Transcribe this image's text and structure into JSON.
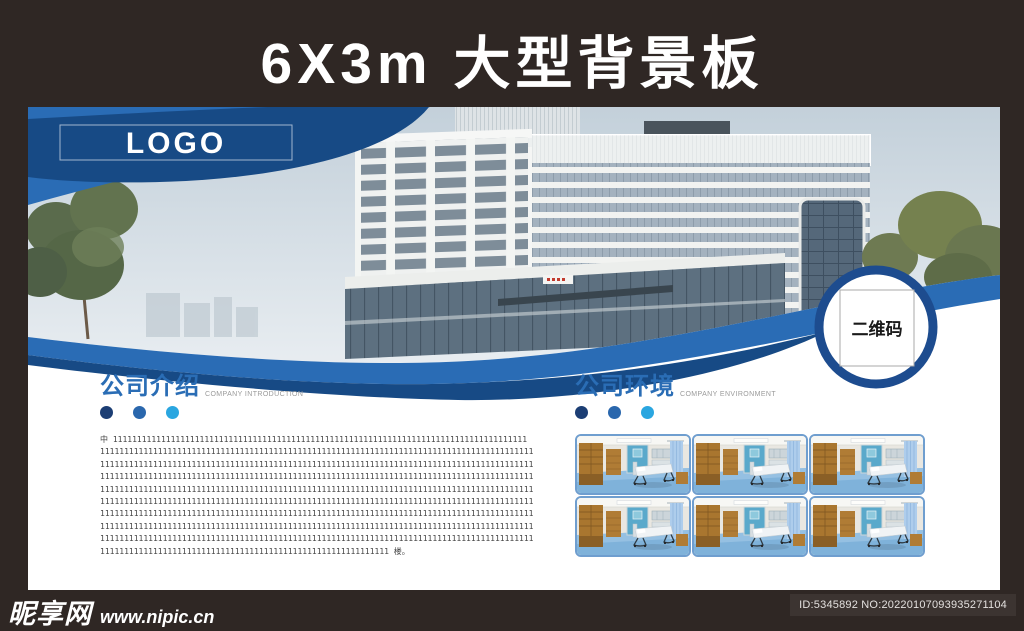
{
  "header": {
    "title": "6X3m 大型背景板"
  },
  "banner": {
    "logo": "LOGO",
    "qr_label": "二维码"
  },
  "sections": {
    "intro": {
      "title": "公司介绍",
      "subtitle": "COMPANY INTRODUCTION",
      "body": [
        "    中 11111111111111111111111111111111111111111111111111111111111111111111111111111111111111",
        "111111111111111111111111111111111111111111111111111111111111111111111111111111111111111111",
        "111111111111111111111111111111111111111111111111111111111111111111111111111111111111111111",
        "111111111111111111111111111111111111111111111111111111111111111111111111111111111111111111",
        "111111111111111111111111111111111111111111111111111111111111111111111111111111111111111111",
        "111111111111111111111111111111111111111111111111111111111111111111111111111111111111111111",
        "111111111111111111111111111111111111111111111111111111111111111111111111111111111111111111",
        "111111111111111111111111111111111111111111111111111111111111111111111111111111111111111111",
        "111111111111111111111111111111111111111111111111111111111111111111111111111111111111111111",
        "111111111111111111111111111111111111111111111111111111111111 楼。"
      ]
    },
    "environment": {
      "title": "公司环境",
      "subtitle": "COMPANY ENVIRONMENT",
      "photo_count": 6
    }
  },
  "footer": {
    "site_name": "昵享网",
    "site_url": "www.nipic.cn",
    "id_text": "ID:5345892 NO:20220107093935271104"
  },
  "colors": {
    "frame_brown": "#2f2724",
    "primary_blue": "#2a6cb5",
    "navy_blue": "#174a85",
    "light_blue": "#2aa6e0",
    "heading_blue": "#2a6db5",
    "thumb_border": "#6f9ecf"
  }
}
